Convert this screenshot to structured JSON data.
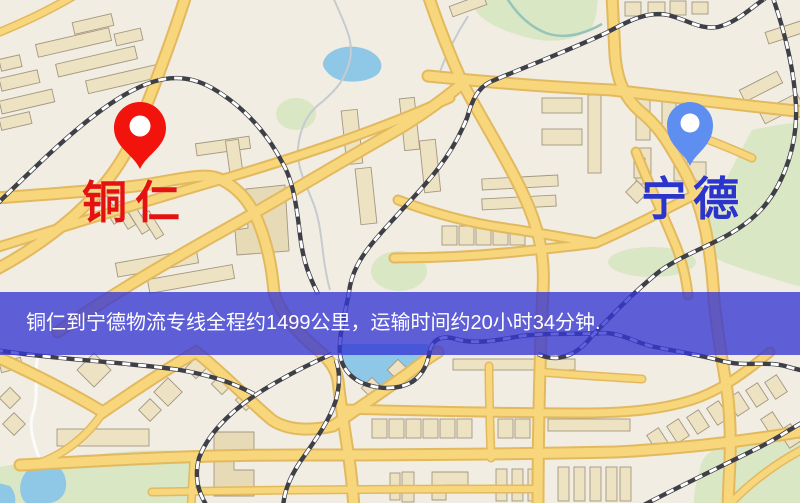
{
  "banner": {
    "text": "铜仁到宁德物流专线全程约1499公里，运输时间约20小时34分钟."
  },
  "markers": {
    "origin": {
      "label": "铜仁",
      "pin_color": "#F2140C",
      "label_color": "#E41312"
    },
    "destination": {
      "label": "宁德",
      "pin_color": "#5E8FF0",
      "label_color": "#2B35CC"
    }
  },
  "colors": {
    "background": "#F1EDE2",
    "park": "#D9E7C4",
    "water": "#8FC7E7",
    "road_fill": "#F8D77C",
    "road_casing": "#E2B95F",
    "railway_dark": "#3F3F48",
    "building_fill": "#EDE2C2",
    "building_stroke": "#A39781",
    "banner_bg": "rgba(52,54,212,0.78)",
    "banner_text_color": "#FFFFFF"
  }
}
